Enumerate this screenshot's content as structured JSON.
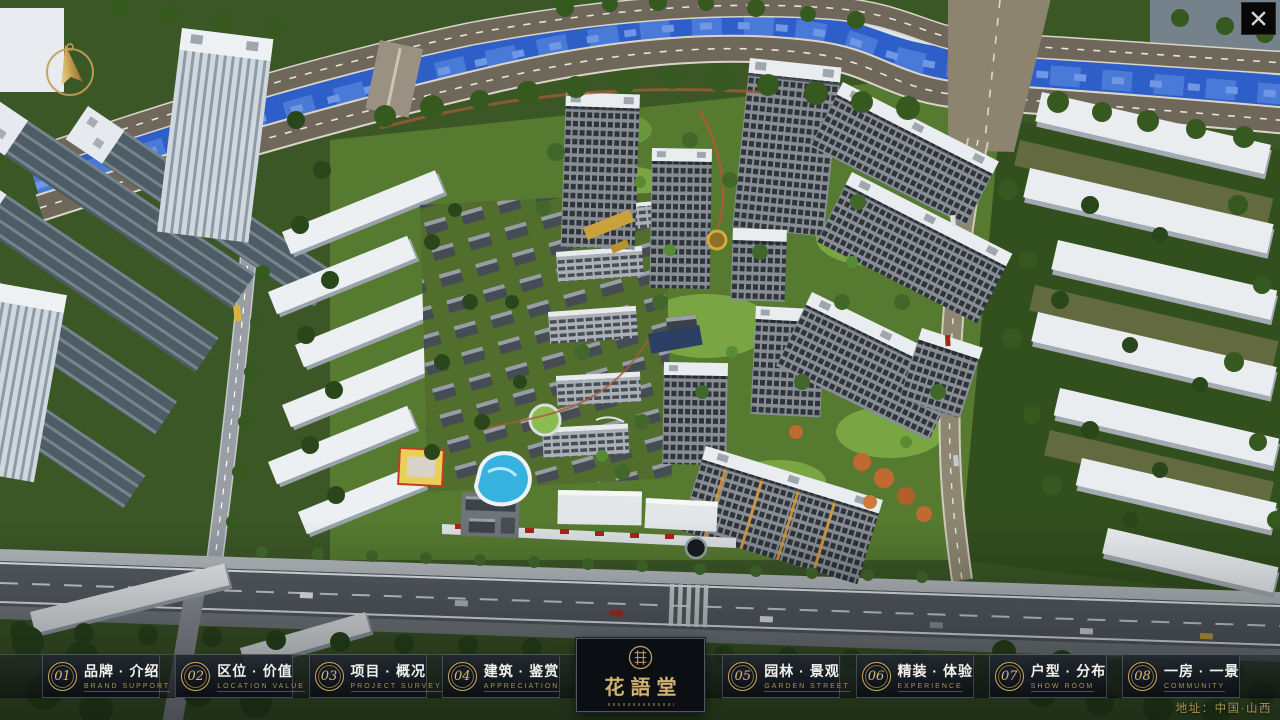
{
  "nav": {
    "items": [
      {
        "num": "01",
        "zh": "品牌 · 介绍",
        "en": "BRAND SUPPORT"
      },
      {
        "num": "02",
        "zh": "区位 · 价值",
        "en": "LOCATION VALUE"
      },
      {
        "num": "03",
        "zh": "项目 · 概况",
        "en": "PROJECT SURVEY"
      },
      {
        "num": "04",
        "zh": "建筑 · 鉴赏",
        "en": "APPRECIATION"
      },
      {
        "num": "05",
        "zh": "园林 · 景观",
        "en": "GARDEN STREET"
      },
      {
        "num": "06",
        "zh": "精装 · 体验",
        "en": "EXPERIENCE"
      },
      {
        "num": "07",
        "zh": "户型 · 分布",
        "en": "SHOW ROOM"
      },
      {
        "num": "08",
        "zh": "一房 · 一景",
        "en": "COMMUNITY"
      }
    ]
  },
  "logo": {
    "title": "花語堂"
  },
  "footer": {
    "address": "地址：中国·山西"
  },
  "icons": {
    "close": "close-x",
    "compass": "north-needle",
    "seal": "brand-seal"
  },
  "colors": {
    "gold": "#c9a85f",
    "nav_zh": "#f2f1ee",
    "nav_en": "#a8905a",
    "river": "#2e5fc9"
  }
}
